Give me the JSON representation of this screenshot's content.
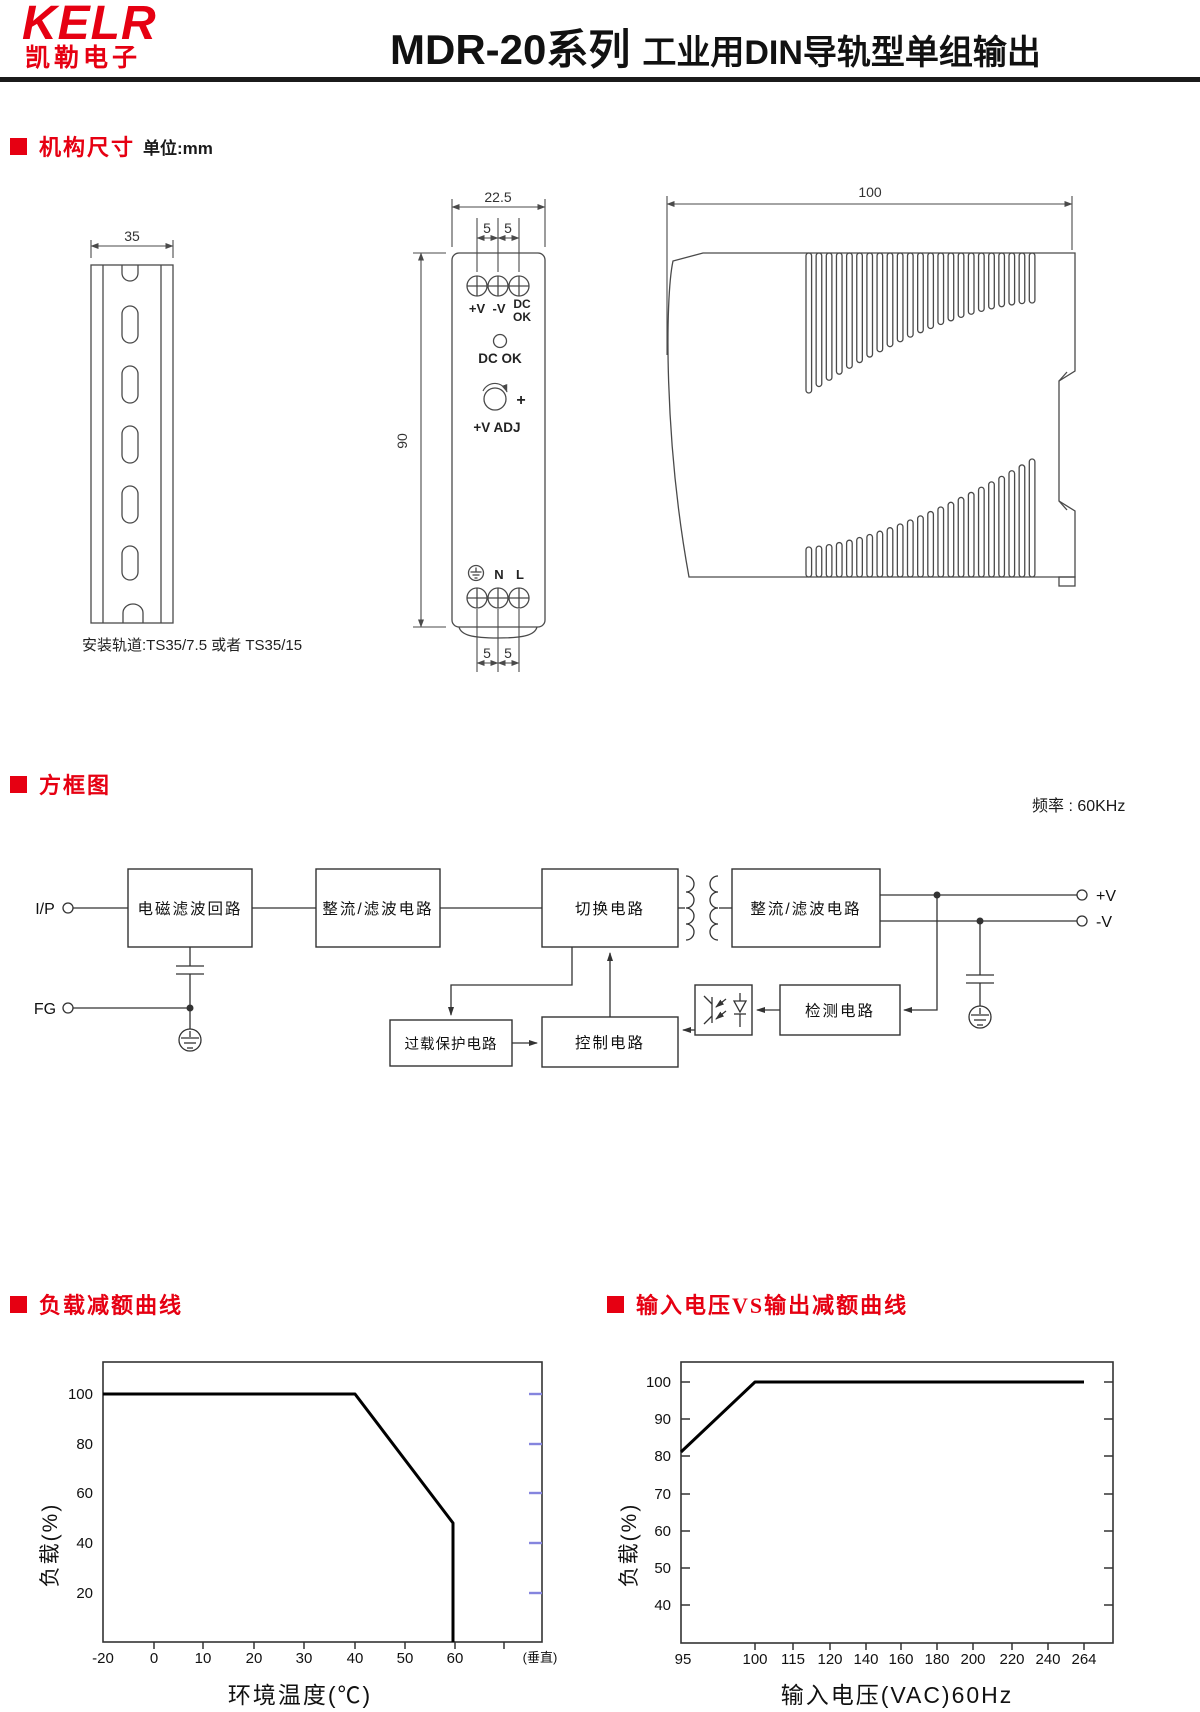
{
  "page": {
    "accent_red": "#e60012",
    "line_color": "#4a4a4a"
  },
  "header": {
    "logo_primary": "KELR",
    "logo_secondary": "凯勒电子",
    "title_model": "MDR-20系列",
    "title_desc": "工业用DIN导轨型单组输出"
  },
  "sections": {
    "mech_label": "机构尺寸",
    "mech_unit": "单位:mm",
    "block_label": "方框图",
    "block_freq_note": "频率 : 60KHz",
    "chart1_label": "负载减额曲线",
    "chart2_label": "输入电压VS输出减额曲线"
  },
  "mech": {
    "rail_width": "35",
    "rail_caption": "安装轨道:TS35/7.5 或者 TS35/15",
    "front_width": "22.5",
    "front_height": "90",
    "pitch_top_1": "5",
    "pitch_top_2": "5",
    "pitch_bottom_1": "5",
    "pitch_bottom_2": "5",
    "term_pos": "+V",
    "term_neg": "-V",
    "term_dc": "DC",
    "term_ok": "OK",
    "led_label": "DC OK",
    "adj_label": "+V ADJ",
    "adj_plus": "+",
    "term_n": "N",
    "term_l": "L",
    "side_depth": "100"
  },
  "block": {
    "input_label": "I/P",
    "fg_label": "FG",
    "emi_box": "电磁滤波回路",
    "rect1_box": "整流/滤波电路",
    "switch_box": "切换电路",
    "rect2_box": "整流/滤波电路",
    "overload_box": "过载保护电路",
    "control_box": "控制电路",
    "detect_box": "检测电路",
    "out_pos": "+V",
    "out_neg": "-V"
  },
  "chart_data": [
    {
      "type": "line",
      "title": "负载减额曲线",
      "xlabel": "环境温度(℃)",
      "ylabel": "负载(%)",
      "x_ticks": [
        "-20",
        "0",
        "10",
        "20",
        "30",
        "40",
        "50",
        "60"
      ],
      "x_axis_note": "(垂直)",
      "y_ticks": [
        "20",
        "40",
        "60",
        "80",
        "100"
      ],
      "xlim": [
        -20,
        75
      ],
      "ylim": [
        0,
        113
      ],
      "grid": false,
      "legend": false,
      "series": [
        {
          "name": "负载",
          "points_x": [
            -20,
            40,
            59,
            59
          ],
          "points_y": [
            100,
            100,
            48,
            0
          ]
        }
      ]
    },
    {
      "type": "line",
      "title": "输入电压VS输出减额曲线",
      "xlabel": "输入电压(VAC)60Hz",
      "ylabel": "负载(%)",
      "x_ticks": [
        "95",
        "100",
        "115",
        "120",
        "140",
        "160",
        "180",
        "200",
        "220",
        "240",
        "264"
      ],
      "x_scale": "nonlinear",
      "y_ticks": [
        "40",
        "50",
        "60",
        "70",
        "80",
        "90",
        "100"
      ],
      "ylim": [
        33,
        105
      ],
      "grid": false,
      "legend": false,
      "series": [
        {
          "name": "负载",
          "points_x": [
            95,
            100,
            264
          ],
          "points_y": [
            81,
            100,
            100
          ]
        }
      ]
    }
  ]
}
